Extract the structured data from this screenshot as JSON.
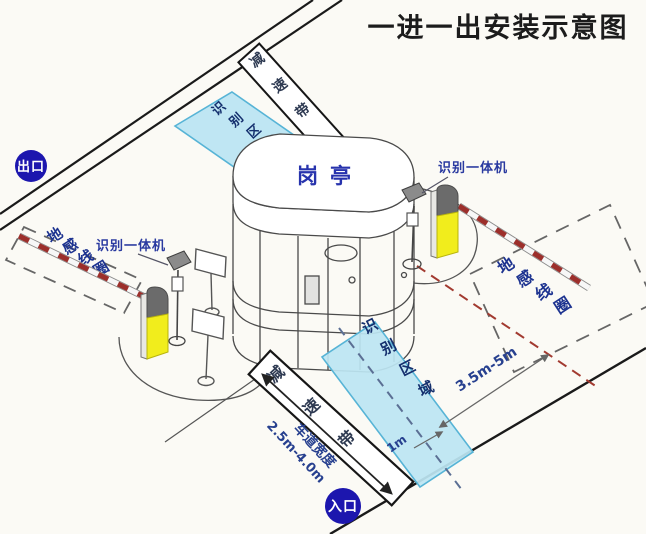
{
  "title": "一进一出安装示意图",
  "badges": {
    "exit": "出口",
    "entrance": "入口"
  },
  "booth": {
    "label": "岗亭"
  },
  "zones": {
    "recognition_top": "识别区域",
    "recognition_bottom": "识别区域"
  },
  "speed_bumps": {
    "top": "减速带",
    "bottom": "减速带"
  },
  "cameras": {
    "left_label": "识别一体机",
    "right_label": "识别一体机"
  },
  "coils": {
    "left": "地感线圈",
    "right": "地感线圈"
  },
  "measurements": {
    "coil_to_zone": "3.5m-5m",
    "zone_depth": "1m",
    "lane_width_title": "车道宽度",
    "lane_width_range": "2.5m-4.0m"
  },
  "colors": {
    "badge_blue": "#1c16ae",
    "zone_fill": "#bce5f2",
    "zone_border": "#57b4d6",
    "label_blue": "#2a3aa0",
    "gate_yellow": "#f1ed1c",
    "gate_cap_gray": "#6b6b6b",
    "arm_red": "#9c2f2b",
    "coil_text_blue": "#1d3390"
  }
}
